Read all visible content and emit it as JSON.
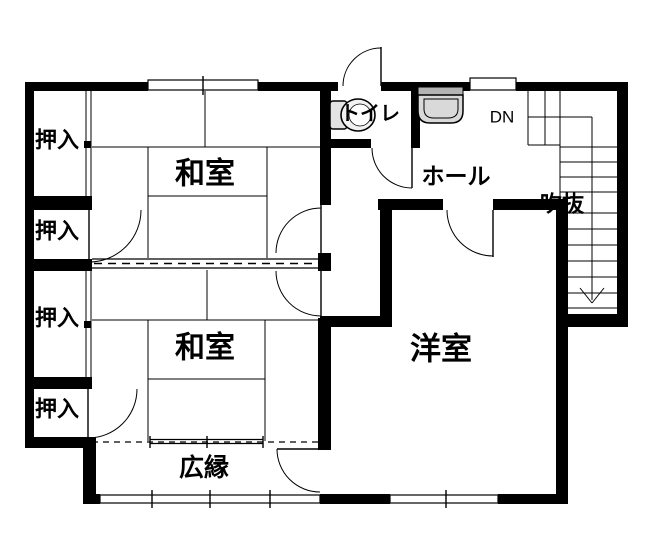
{
  "floorplan": {
    "labels": {
      "closet": "押入",
      "japanese_room": "和室",
      "toilet": "トイレ",
      "hall": "ホール",
      "down": "DN",
      "atrium": "吹抜",
      "veranda": "広縁",
      "western_room": "洋室"
    },
    "colors": {
      "wall": "#000000",
      "background": "#ffffff",
      "fixture_body": "#d9d9d9",
      "fixture_top": "#b3b3b3",
      "toilet_tank": "#e3e3e3",
      "toilet_bowl": "#f2f2f2"
    }
  }
}
